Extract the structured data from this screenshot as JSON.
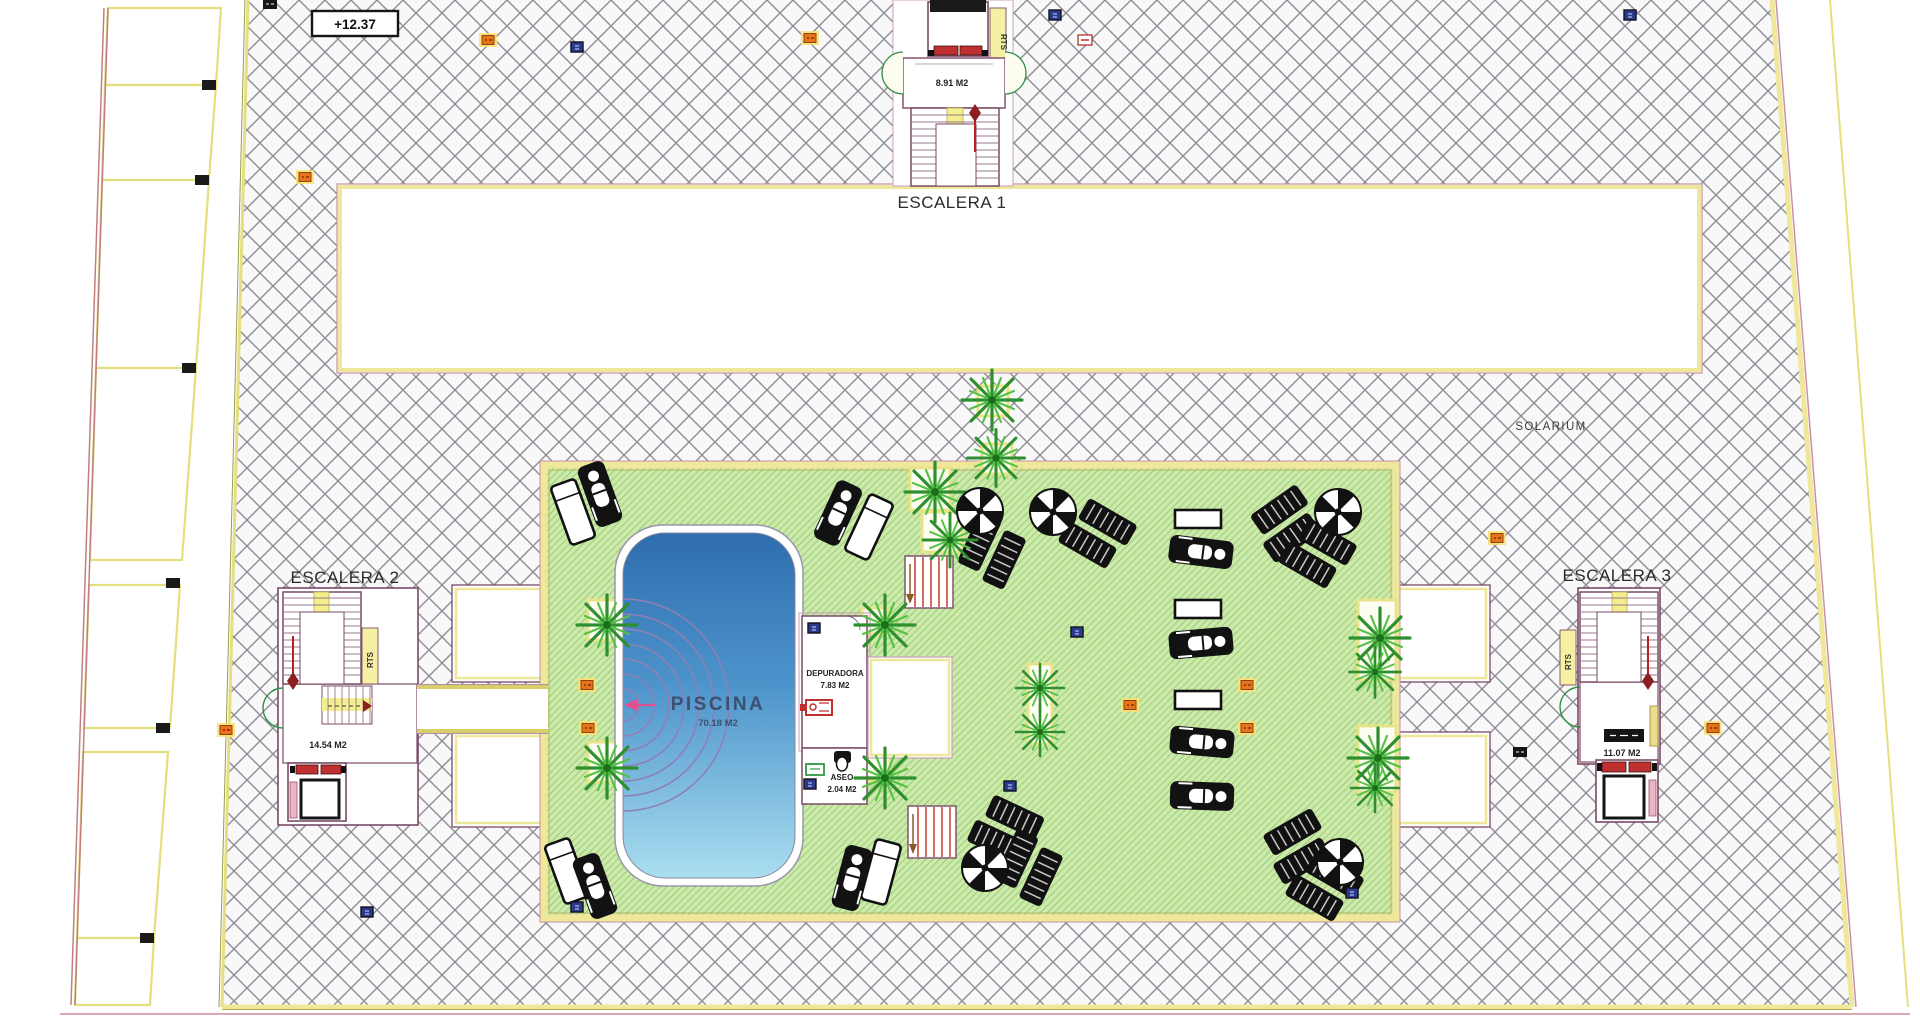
{
  "labels": {
    "escalera1": "ESCALERA 1",
    "escalera2": "ESCALERA 2",
    "escalera3": "ESCALERA 3",
    "solarium": "SOLARIUM",
    "elevation": "+12.37",
    "piscina": "PISCINA",
    "piscina_area": "70.18 M2",
    "depuradora": "DEPURADORA",
    "depuradora_area": "7.83 M2",
    "aseo": "ASEO",
    "aseo_area": "2.04 M2",
    "e1_area": "8.91 M2",
    "e2_area": "14.54 M2",
    "e3_area": "11.07 M2",
    "rts": "RTS"
  },
  "colors": {
    "hatch_line": "#8C8C96",
    "boundary_yellow": "#EFE79A",
    "boundary_pink": "#C890A8",
    "deck_green": "#CFE9AD",
    "deck_green_line": "#9CD47C",
    "planter_yellow": "#E8E28A",
    "wall_purple": "#7A4A66",
    "stair_yellow": "#F3EF8E",
    "accent_red": "#C03030",
    "pool_deep": "#2E6DAE",
    "pool_mid": "#4E95CC",
    "pool_light": "#AADEF0",
    "pool_steps_arc": "#8F7FB5",
    "palm_green": "#2E8F2E",
    "tag_orange": "#E8731A",
    "tag_navy": "#2B3A8C"
  },
  "furniture": {
    "palms": [
      {
        "x": 607,
        "y": 625,
        "s": 1
      },
      {
        "x": 607,
        "y": 768,
        "s": 1
      },
      {
        "x": 885,
        "y": 625,
        "s": 1
      },
      {
        "x": 885,
        "y": 778,
        "s": 1
      },
      {
        "x": 935,
        "y": 492,
        "s": 1
      },
      {
        "x": 950,
        "y": 540,
        "s": 0.9
      },
      {
        "x": 992,
        "y": 400,
        "s": 1
      },
      {
        "x": 996,
        "y": 458,
        "s": 0.95
      },
      {
        "x": 1040,
        "y": 688,
        "s": 0.8
      },
      {
        "x": 1040,
        "y": 732,
        "s": 0.8
      },
      {
        "x": 1380,
        "y": 638,
        "s": 1
      },
      {
        "x": 1375,
        "y": 672,
        "s": 0.85
      },
      {
        "x": 1378,
        "y": 758,
        "s": 1
      },
      {
        "x": 1375,
        "y": 788,
        "s": 0.8
      }
    ],
    "planters": [
      {
        "x": 588,
        "y": 600,
        "w": 38,
        "h": 40
      },
      {
        "x": 588,
        "y": 742,
        "w": 38,
        "h": 40
      },
      {
        "x": 862,
        "y": 608,
        "w": 26,
        "h": 26
      },
      {
        "x": 862,
        "y": 755,
        "w": 28,
        "h": 26
      },
      {
        "x": 910,
        "y": 468,
        "w": 40,
        "h": 42
      },
      {
        "x": 922,
        "y": 512,
        "w": 40,
        "h": 40
      },
      {
        "x": 978,
        "y": 386,
        "w": 30,
        "h": 30
      },
      {
        "x": 982,
        "y": 444,
        "w": 30,
        "h": 30
      },
      {
        "x": 1028,
        "y": 664,
        "w": 24,
        "h": 80
      },
      {
        "x": 1358,
        "y": 600,
        "w": 38,
        "h": 80
      },
      {
        "x": 1358,
        "y": 726,
        "w": 38,
        "h": 66
      }
    ],
    "parasols": [
      {
        "x": 980,
        "y": 511
      },
      {
        "x": 1053,
        "y": 512
      },
      {
        "x": 1338,
        "y": 512
      },
      {
        "x": 985,
        "y": 868
      },
      {
        "x": 1340,
        "y": 862
      }
    ],
    "loungers_white": [
      {
        "x": 573,
        "y": 512,
        "r": -20
      },
      {
        "x": 869,
        "y": 527,
        "r": 25
      },
      {
        "x": 881,
        "y": 872,
        "r": 15
      },
      {
        "x": 567,
        "y": 871,
        "r": -20
      }
    ],
    "loungers_person": [
      {
        "x": 600,
        "y": 494,
        "r": -20
      },
      {
        "x": 838,
        "y": 513,
        "r": 25
      },
      {
        "x": 852,
        "y": 878,
        "r": 15
      },
      {
        "x": 595,
        "y": 886,
        "r": -20
      },
      {
        "x": 1201,
        "y": 552,
        "r": 97
      },
      {
        "x": 1201,
        "y": 643,
        "r": 85
      },
      {
        "x": 1202,
        "y": 742,
        "r": 95
      },
      {
        "x": 1202,
        "y": 796,
        "r": 92
      }
    ],
    "striped_pairs": [
      {
        "x": 993,
        "y": 548,
        "r": 25
      },
      {
        "x": 1095,
        "y": 532,
        "r": -60
      },
      {
        "x": 1288,
        "y": 522,
        "r": 55
      },
      {
        "x": 1315,
        "y": 552,
        "r": -60
      },
      {
        "x": 1003,
        "y": 828,
        "r": -65
      },
      {
        "x": 1030,
        "y": 865,
        "r": 25
      },
      {
        "x": 1300,
        "y": 845,
        "r": 60
      },
      {
        "x": 1322,
        "y": 885,
        "r": -60
      }
    ],
    "tables": [
      {
        "x": 1198,
        "y": 519
      },
      {
        "x": 1198,
        "y": 609
      },
      {
        "x": 1198,
        "y": 700
      }
    ],
    "red_stairs": [
      {
        "x": 905,
        "y": 556
      },
      {
        "x": 908,
        "y": 806
      }
    ],
    "tags": [
      {
        "x": 488,
        "y": 40,
        "t": "orange"
      },
      {
        "x": 810,
        "y": 38,
        "t": "orange"
      },
      {
        "x": 305,
        "y": 177,
        "t": "orange"
      },
      {
        "x": 587,
        "y": 685,
        "t": "orange"
      },
      {
        "x": 588,
        "y": 728,
        "t": "orange"
      },
      {
        "x": 1130,
        "y": 705,
        "t": "orange"
      },
      {
        "x": 1247,
        "y": 685,
        "t": "orange"
      },
      {
        "x": 1247,
        "y": 728,
        "t": "orange"
      },
      {
        "x": 1497,
        "y": 538,
        "t": "orange"
      },
      {
        "x": 1713,
        "y": 728,
        "t": "orange"
      },
      {
        "x": 577,
        "y": 47,
        "t": "navy"
      },
      {
        "x": 1055,
        "y": 15,
        "t": "navy"
      },
      {
        "x": 1630,
        "y": 15,
        "t": "navy"
      },
      {
        "x": 1077,
        "y": 632,
        "t": "navy"
      },
      {
        "x": 1010,
        "y": 786,
        "t": "navy"
      },
      {
        "x": 367,
        "y": 912,
        "t": "navy"
      },
      {
        "x": 1352,
        "y": 893,
        "t": "navy"
      },
      {
        "x": 577,
        "y": 907,
        "t": "navy"
      },
      {
        "x": 814,
        "y": 628,
        "t": "navy"
      },
      {
        "x": 810,
        "y": 784,
        "t": "navy"
      },
      {
        "x": 1085,
        "y": 40,
        "t": "red"
      },
      {
        "x": 226,
        "y": 730,
        "t": "orangered"
      },
      {
        "x": 270,
        "y": 4,
        "t": "black"
      },
      {
        "x": 1520,
        "y": 752,
        "t": "black"
      }
    ]
  }
}
